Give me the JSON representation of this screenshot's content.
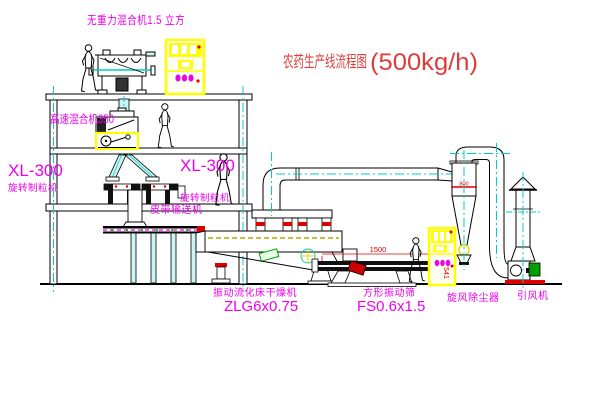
{
  "title": {
    "text": "农药生产线流程图",
    "capacity": "(500kg/h)"
  },
  "labels": {
    "gravity_mixer": "无重力混合机1.5 立方",
    "high_speed_mixer": "高速混合机350",
    "left_granulator_model": "XL-300",
    "left_granulator_name": "旋转制粒机",
    "mid_granulator_model": "XL-300",
    "mid_granulator_name": "旋转制粒机",
    "belt_conveyor": "皮带输送机",
    "dryer_name": "振动流化床干燥机",
    "dryer_model": "ZLG6x0.75",
    "sieve_name": "方形振动筛",
    "sieve_model": "FS0.6x1.5",
    "cyclone": "旋风除尘器",
    "fan": "引风机"
  },
  "dimensions": {
    "sieve_length": "1500",
    "sieve_height": "541",
    "cyclone_diameter": "800"
  },
  "colors": {
    "label_magenta": "#EE00EE",
    "title_red": "#E03C3C",
    "centerline_cyan": "#00CCCC",
    "duct_fill_cyan": "#CCF4F4",
    "highlight_yellow": "#FFFF00",
    "accent_red": "#DD0000",
    "accent_green": "#00A000",
    "bed_olive": "#AAAA00"
  }
}
